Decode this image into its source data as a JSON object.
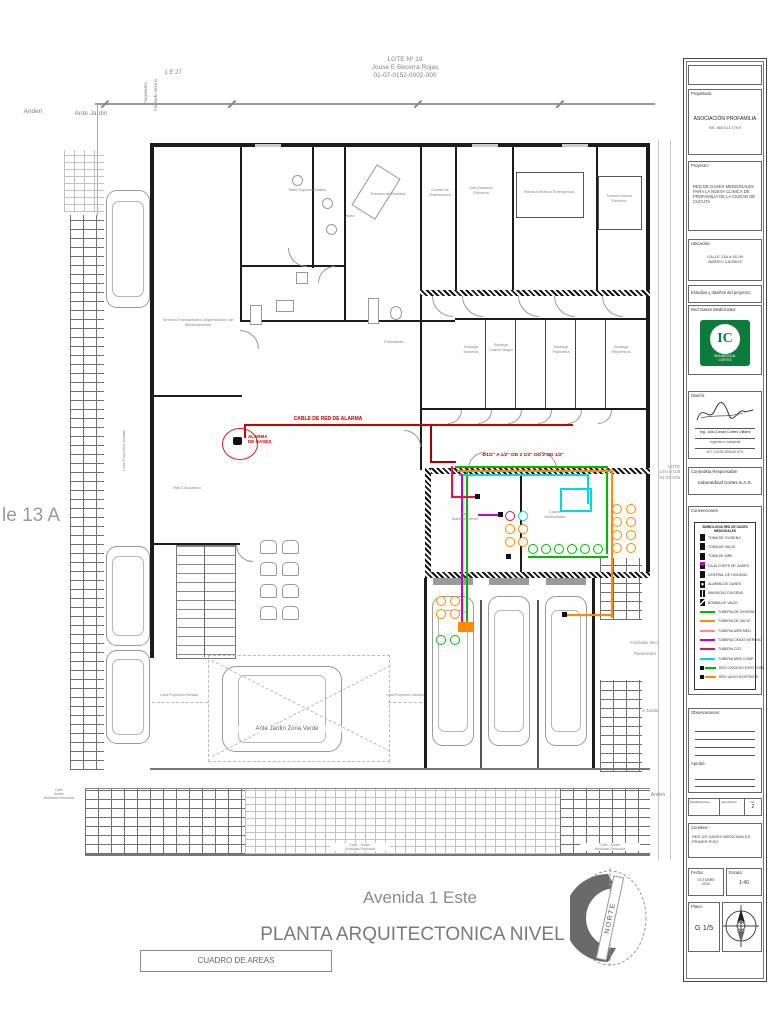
{
  "colors": {
    "oxygen_green": "#00b800",
    "vacuum_orange": "#ff8c00",
    "air_cyan": "#00d8e0",
    "n2o_magenta": "#c800c8",
    "co2_pink": "#e81150",
    "salmon": "#ff8d70",
    "alarm_red": "#c40000",
    "logo_green": "#0e7a3c"
  },
  "plan": {
    "header": {
      "lot": "LOTE Nº 19\nJouse E Becerra  Rojas\n01-07-0152-0002-000",
      "scale_ref": "1 E 27"
    },
    "street_left": "le 13 A",
    "neighbor_lot": "LOTE\nLino A Gal\n01-07-015",
    "labels": {
      "anden_top": "Anden",
      "ante_jardin_top": "Ante Jardin",
      "fachada_vecino_top": "Fachada Vecino",
      "paramento_top": "Paramento",
      "fachada_vecino_right": "Fachada Veci",
      "paramento_right": "Paramento",
      "ante_jardin_right": "Ante Jardin",
      "anden_right": "Anden",
      "zona_verde": "Ante Jardin Zona Verde",
      "linea_fachada": "Línea Proyección Fachada",
      "linea_voladizo": "Línea Proyección Voladizo",
      "sw_left": "Calle\nAnden\nMovilidad Reducida",
      "sw_center": "Calle - Anden\nMovilidad Reducida",
      "sw_right": "Calle - Anden\nMovilidad Reducida"
    },
    "annotations": {
      "alarm_cable": "CABLE DE RED DE ALARMA",
      "alarm_device": "ALARMA\nDE GASES",
      "pipe_sizes": "Ø1/2\" A 1/2\" OD 2 1/2\" OD 2 OD 1/2\""
    },
    "rooms": [
      {
        "text": "Servicio Farmacéutico Dispensación de Medicamentos"
      },
      {
        "text": "Taller Experimentales"
      },
      {
        "text": "Entrada de Botellas"
      },
      {
        "text": "Aseo"
      },
      {
        "text": "Cuarto de Subestación"
      },
      {
        "text": "Sub Estación Eléctrica"
      },
      {
        "text": "Planta Eléctrica Emergencia"
      },
      {
        "text": "Transformador Eléctrico"
      },
      {
        "text": "Polivalente"
      },
      {
        "text": "Bodega Insumos"
      },
      {
        "text": "Bodega Cuarto Negro"
      },
      {
        "text": "Bodega Papelería"
      },
      {
        "text": "Bodega Repuestos"
      },
      {
        "text": "Taller Mantenimiento"
      },
      {
        "text": "Cuarto Medicinales"
      },
      {
        "text": "Hall Circulación"
      }
    ],
    "titles": {
      "street_title": "Avenida 1 Este",
      "plan_title": "PLANTA ARQUITECTONICA NIVEL 1",
      "areas_box": "CUADRO DE AREAS",
      "north": "NORTE"
    }
  },
  "titleblock": {
    "propietario_label": "Propietario:",
    "propietario_name": "ASOCIACIÓN PROFAMILIA",
    "propietario_nit": "NIT. 860.013.779-9",
    "proyecto_label": "Proyecto:",
    "proyecto_text": "RED DE GASES MEDICINALES PARA LA NUEVA CLINICA DE PROFAMILIA DE LA CIUDAD DE CUCUTA",
    "ubicacion_label": "Ubicación:",
    "ubicacion_text": "CALLE 13A # 1E-09\nBARRIO CAOBOS",
    "estudios_label": "Estudios y diseños del proyecto:",
    "red_gases_label": "Red Gases Medicinales:",
    "logo_text": "IC",
    "logo_sub": "INDUMEDICAL\nCORTES",
    "diseno_label": "Diseñó:",
    "diseno_name": "Ing. Julio Cesar Cortes Villami",
    "diseno_title": "Ingeniero Industrial",
    "diseno_reg": "M.P. 54228-298445 NTS",
    "contratista_label": "Contratista Responsable:",
    "contratista_name": "Indumedical Cortes S.A.S.",
    "convenciones_label": "Convenciones:",
    "observaciones_label": "Observaciones:",
    "aprobo_label": "Aprobó:",
    "rev": {
      "col1": "Modificaciones",
      "col2": "Aprobación",
      "col3": "No.",
      "version": "2"
    },
    "contiene_label": "Contiene:",
    "contiene_text": "RED DE GASES MEDICINALES\nPRIMER PISO",
    "fecha_label": "Fecha:",
    "fecha_value": "OCTUBRE\n2020",
    "escala_label": "Escala:",
    "escala_value": "1:40",
    "plano_label": "Plano:",
    "plano_value": "G 1/5"
  },
  "legend": {
    "title": "SIMBOLOGIA RED DE GASES\nMEDICINALES",
    "symbols": [
      {
        "label": "TOMA DE OXIGENO"
      },
      {
        "label": "TOMA DE VACIO"
      },
      {
        "label": "TOMA DE AIRE"
      },
      {
        "label": "CAJA CORTE DE GASES"
      },
      {
        "label": "CENTRAL DE OXIGENO"
      },
      {
        "label": "ALARMA DE GASES"
      },
      {
        "label": "MANIFOLD OXIGENO"
      },
      {
        "label": "BOMBA DE VACIO"
      }
    ],
    "lines": [
      {
        "label": "TUBERIA DE OXIGENO",
        "color": "#00b800"
      },
      {
        "label": "TUBERIA DE VACIO",
        "color": "#ff8c00"
      },
      {
        "label": "TUBERIA AIRE MED.",
        "color": "#ff8d70"
      },
      {
        "label": "TUBERIA OXIDO NITROSO",
        "color": "#c800c8"
      },
      {
        "label": "TUBERIA CO2",
        "color": "#e81150"
      },
      {
        "label": "TUBERIA AIRE COMP.",
        "color": "#00d8e0"
      },
      {
        "label": "RED OXIGENO EXISTENTE",
        "color": "#00b800"
      },
      {
        "label": "RED VACIO EXISTENTE",
        "color": "#ff8c00"
      }
    ]
  }
}
